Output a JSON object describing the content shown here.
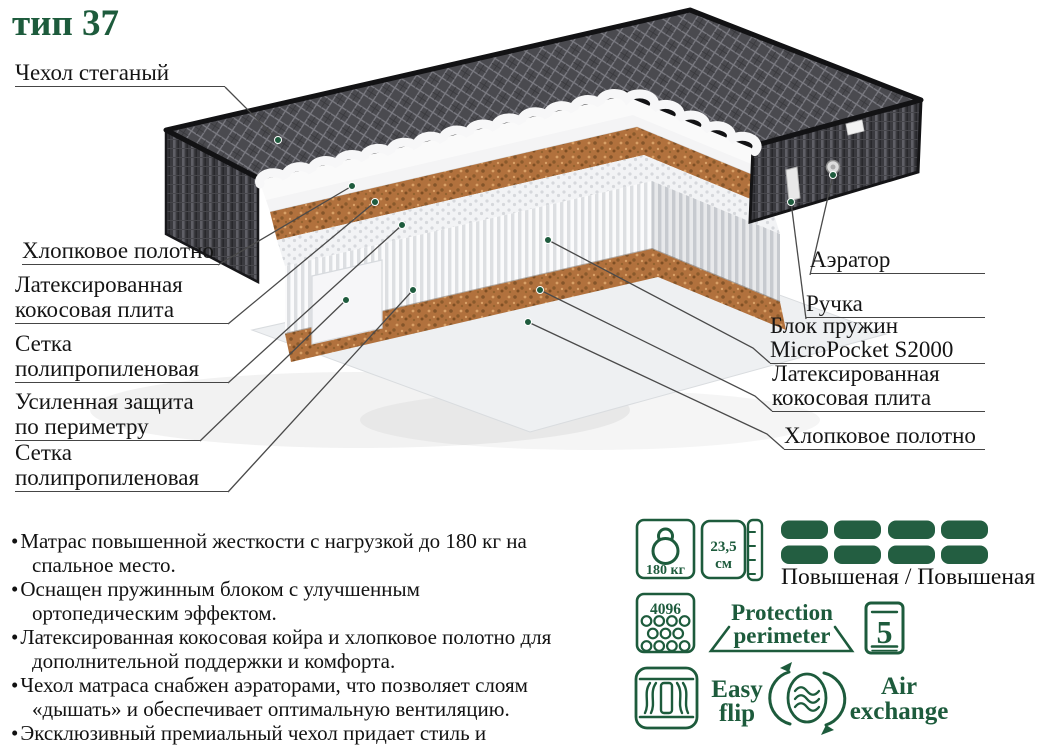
{
  "title": "тип 37",
  "colors": {
    "accent_green": "#1d5b3c",
    "dash_green": "#235e41",
    "coir_brown": "#b1713d",
    "cover_gray": "#4a4a4f",
    "label_text": "#151515"
  },
  "diagram": {
    "labels_left": [
      {
        "text": "Чехол стеганый"
      },
      {
        "text": "Хлопковое полотно"
      },
      {
        "text": "Латексированная кокосовая плита"
      },
      {
        "text": "Сетка полипропиленовая"
      },
      {
        "text": "Усиленная защита по периметру"
      },
      {
        "text": "Сетка полипропиленовая"
      }
    ],
    "labels_right": [
      {
        "text": "Аэратор"
      },
      {
        "text": "Ручка"
      },
      {
        "text": "Блок пружин MicroPocket S2000"
      },
      {
        "text": "Латексированная кокосовая плита"
      },
      {
        "text": "Хлопковое полотно"
      }
    ]
  },
  "features": [
    "Матрас повышенной жесткости с нагрузкой до 180 кг на спальное место.",
    "Оснащен пружинным блоком с улучшенным ортопедическим эффектом.",
    "Латексированная кокосовая койра и хлопковое полотно для дополнительной поддержки и комфорта.",
    "Чехол матраса снабжен аэраторами, что позволяет слоям «дышать» и обеспечивает оптимальную вентиляцию.",
    "Эксклюзивный премиальный чехол придает стиль и долговечность."
  ],
  "specs": {
    "max_load": "180 кг",
    "height_value": "23,5",
    "height_unit": "см",
    "firmness": "Повышеная / Повышеная",
    "springs_count": "4096",
    "protection_line1": "Protection",
    "protection_line2": "perimeter",
    "warranty_years": "5",
    "flip_line1": "Easy",
    "flip_line2": "flip",
    "air_line1": "Air",
    "air_line2": "exchange"
  }
}
